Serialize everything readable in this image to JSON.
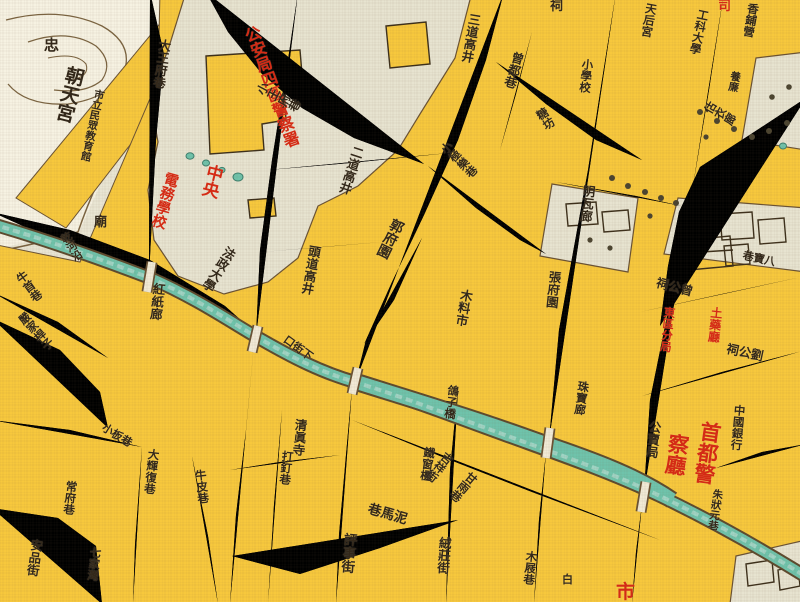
{
  "map": {
    "palette": {
      "base_paper": "#e9e5d3",
      "block_yellow": "#f7c83d",
      "street_fill": "#f1ead6",
      "street_casing": "#6a5233",
      "canal_teal": "#6fc3ab",
      "hill_cream": "#f6f2e2",
      "compound_gray": "#e7e3d0",
      "label_black": "#33281a",
      "label_red": "#d42b15"
    },
    "labels": [
      {
        "id": "zhong",
        "text": "忠",
        "x": 44,
        "y": 38,
        "size": 15,
        "color": "black",
        "rot": 0,
        "dir": "h"
      },
      {
        "id": "chaotiangong",
        "text": "朝天宮",
        "x": 66,
        "y": 64,
        "size": 19,
        "color": "black",
        "rot": 14,
        "dir": "v"
      },
      {
        "id": "minzhong-jiaoyuguan",
        "text": "市立民眾教育館",
        "x": 94,
        "y": 88,
        "size": 10.5,
        "color": "black",
        "rot": 12,
        "dir": "v"
      },
      {
        "id": "dawangfuxiang",
        "text": "大王府巷",
        "x": 158,
        "y": 38,
        "size": 12.5,
        "color": "black",
        "rot": 8,
        "dir": "v"
      },
      {
        "id": "gonganju-jingchashu",
        "text": "公安局四區警察署",
        "x": 240,
        "y": 30,
        "size": 16,
        "color": "red",
        "rot": -20,
        "dir": "v",
        "colh": 64
      },
      {
        "id": "xiaowangfuxiang",
        "text": "小王府巷",
        "x": 254,
        "y": 92,
        "size": 12,
        "color": "black",
        "rot": -62,
        "dir": "v"
      },
      {
        "id": "zhongyang",
        "text": "中央",
        "x": 206,
        "y": 162,
        "size": 17,
        "color": "red",
        "rot": 14,
        "dir": "v"
      },
      {
        "id": "dianwu-xuexiao",
        "text": "電務學校",
        "x": 164,
        "y": 170,
        "size": 14.5,
        "color": "red",
        "rot": 16,
        "dir": "v"
      },
      {
        "id": "fazheng-daxue",
        "text": "法政大學",
        "x": 226,
        "y": 244,
        "size": 12.5,
        "color": "black",
        "rot": 32,
        "dir": "v"
      },
      {
        "id": "hongzhilang",
        "text": "紅紙廊",
        "x": 152,
        "y": 282,
        "size": 12.5,
        "color": "black",
        "rot": 6,
        "dir": "v"
      },
      {
        "id": "qianheyan",
        "text": "乾河沿",
        "x": 58,
        "y": 236,
        "size": 10.5,
        "color": "black",
        "rot": -30,
        "dir": "v"
      },
      {
        "id": "niushouxiang",
        "text": "牛首巷",
        "x": 14,
        "y": 276,
        "size": 11.5,
        "color": "black",
        "rot": -36,
        "dir": "v"
      },
      {
        "id": "yanjiaganzi",
        "text": "嚴家桿子",
        "x": 16,
        "y": 318,
        "size": 11.5,
        "color": "black",
        "rot": -42,
        "dir": "v"
      },
      {
        "id": "miao",
        "text": "廟",
        "x": 94,
        "y": 216,
        "size": 13,
        "color": "black",
        "rot": 0,
        "dir": "h"
      },
      {
        "id": "sandaogaojing",
        "text": "三道高井",
        "x": 468,
        "y": 12,
        "size": 12.5,
        "color": "black",
        "rot": 10,
        "dir": "v"
      },
      {
        "id": "erdaogaojing",
        "text": "二道高井",
        "x": 352,
        "y": 144,
        "size": 12.5,
        "color": "black",
        "rot": 18,
        "dir": "v"
      },
      {
        "id": "toudaogaojing",
        "text": "頭道高井",
        "x": 308,
        "y": 244,
        "size": 12.5,
        "color": "black",
        "rot": 10,
        "dir": "v"
      },
      {
        "id": "zengduxiang",
        "text": "曾都巷",
        "x": 512,
        "y": 50,
        "size": 12.5,
        "color": "black",
        "rot": 16,
        "dir": "v"
      },
      {
        "id": "xiaoxuexiao",
        "text": "小學校",
        "x": 582,
        "y": 58,
        "size": 11.5,
        "color": "black",
        "rot": 6,
        "dir": "v"
      },
      {
        "id": "tangfang",
        "text": "糖坊",
        "x": 534,
        "y": 112,
        "size": 11.5,
        "color": "black",
        "rot": -32,
        "dir": "v"
      },
      {
        "id": "xiaojilexiang",
        "text": "小極樂巷",
        "x": 438,
        "y": 148,
        "size": 11.5,
        "color": "black",
        "rot": -46,
        "dir": "v"
      },
      {
        "id": "guofuyuan",
        "text": "郭府園",
        "x": 392,
        "y": 216,
        "size": 14,
        "color": "black",
        "rot": 26,
        "dir": "v"
      },
      {
        "id": "muliaoshi",
        "text": "木料市",
        "x": 460,
        "y": 288,
        "size": 12.5,
        "color": "black",
        "rot": 10,
        "dir": "v"
      },
      {
        "id": "zhangfuyuan",
        "text": "張府園",
        "x": 548,
        "y": 270,
        "size": 12.5,
        "color": "black",
        "rot": 6,
        "dir": "v"
      },
      {
        "id": "mingwalang",
        "text": "明瓦廊",
        "x": 582,
        "y": 184,
        "size": 12.5,
        "color": "black",
        "rot": 6,
        "dir": "v"
      },
      {
        "id": "tianhougong",
        "text": "天后宮",
        "x": 646,
        "y": 2,
        "size": 11.5,
        "color": "black",
        "rot": 10,
        "dir": "v"
      },
      {
        "id": "gongkedaxue",
        "text": "工科大學",
        "x": 698,
        "y": 8,
        "size": 11.5,
        "color": "black",
        "rot": 12,
        "dir": "v"
      },
      {
        "id": "xiangpuying",
        "text": "香鋪營",
        "x": 748,
        "y": 2,
        "size": 11.5,
        "color": "black",
        "rot": 10,
        "dir": "v"
      },
      {
        "id": "yanglian",
        "text": "養廉",
        "x": 730,
        "y": 70,
        "size": 10.5,
        "color": "black",
        "rot": 10,
        "dir": "v"
      },
      {
        "id": "guyilang",
        "text": "估衣廊",
        "x": 702,
        "y": 110,
        "size": 11.5,
        "color": "black",
        "rot": -60,
        "dir": "v"
      },
      {
        "id": "babaoxiang",
        "text": "巷寶八",
        "x": 744,
        "y": 250,
        "size": 11,
        "color": "black",
        "rot": 12,
        "dir": "h"
      },
      {
        "id": "zenggongci",
        "text": "祠公曾",
        "x": 658,
        "y": 276,
        "size": 12.5,
        "color": "black",
        "rot": 14,
        "dir": "h"
      },
      {
        "id": "tuyaoting",
        "text": "土藥廳",
        "x": 710,
        "y": 306,
        "size": 12,
        "color": "red",
        "rot": 6,
        "dir": "v"
      },
      {
        "id": "dongqufenju",
        "text": "東區分局",
        "x": 664,
        "y": 306,
        "size": 11.5,
        "color": "red",
        "rot": 6,
        "dir": "v"
      },
      {
        "id": "liugongci",
        "text": "祠公劉",
        "x": 728,
        "y": 342,
        "size": 12.5,
        "color": "black",
        "rot": 12,
        "dir": "h"
      },
      {
        "id": "zhubaolang",
        "text": "珠寶廊",
        "x": 578,
        "y": 380,
        "size": 11.5,
        "color": "black",
        "rot": 8,
        "dir": "v"
      },
      {
        "id": "gongmaiju",
        "text": "公賣局",
        "x": 648,
        "y": 420,
        "size": 12.5,
        "color": "black",
        "rot": 6,
        "dir": "v"
      },
      {
        "id": "shoudujing",
        "text": "首都警",
        "x": 700,
        "y": 420,
        "size": 21,
        "color": "red",
        "rot": 8,
        "dir": "v"
      },
      {
        "id": "chating",
        "text": "察廳",
        "x": 668,
        "y": 432,
        "size": 21,
        "color": "red",
        "rot": 8,
        "dir": "v"
      },
      {
        "id": "zhongguo-yinhang",
        "text": "中國銀行",
        "x": 734,
        "y": 404,
        "size": 11.5,
        "color": "black",
        "rot": 5,
        "dir": "v"
      },
      {
        "id": "zhuzhuangyuanxiang",
        "text": "朱狀元巷",
        "x": 712,
        "y": 488,
        "size": 10.5,
        "color": "black",
        "rot": 8,
        "dir": "v"
      },
      {
        "id": "geziqiao",
        "text": "鴿子橋",
        "x": 448,
        "y": 384,
        "size": 11.5,
        "color": "black",
        "rot": 8,
        "dir": "v"
      },
      {
        "id": "tiechuangling",
        "text": "鐵窗欞",
        "x": 424,
        "y": 446,
        "size": 11.5,
        "color": "black",
        "rot": 8,
        "dir": "v"
      },
      {
        "id": "xiajiekou",
        "text": "口街下",
        "x": 288,
        "y": 334,
        "size": 11,
        "color": "black",
        "rot": 36,
        "dir": "h"
      },
      {
        "id": "qingzhensi",
        "text": "清眞寺",
        "x": 294,
        "y": 418,
        "size": 12.5,
        "color": "black",
        "rot": 5,
        "dir": "v"
      },
      {
        "id": "dadingxiang",
        "text": "打釘巷",
        "x": 282,
        "y": 450,
        "size": 11.5,
        "color": "black",
        "rot": 6,
        "dir": "v"
      },
      {
        "id": "pingshijie",
        "text": "評事街",
        "x": 342,
        "y": 532,
        "size": 13.5,
        "color": "black",
        "rot": 5,
        "dir": "v"
      },
      {
        "id": "nimaxiang",
        "text": "巷馬泥",
        "x": 370,
        "y": 502,
        "size": 13.5,
        "color": "black",
        "rot": 16,
        "dir": "h"
      },
      {
        "id": "jixiangjie",
        "text": "吉祥街",
        "x": 446,
        "y": 450,
        "size": 11.5,
        "color": "black",
        "rot": 40,
        "dir": "v"
      },
      {
        "id": "ganyuxiang",
        "text": "甘雨巷",
        "x": 470,
        "y": 470,
        "size": 11.5,
        "color": "black",
        "rot": 40,
        "dir": "v"
      },
      {
        "id": "rongzhuangjie",
        "text": "絨莊街",
        "x": 438,
        "y": 536,
        "size": 12.5,
        "color": "black",
        "rot": 4,
        "dir": "v"
      },
      {
        "id": "dahuifuxiang",
        "text": "大輝復巷",
        "x": 148,
        "y": 448,
        "size": 11.5,
        "color": "black",
        "rot": 6,
        "dir": "v"
      },
      {
        "id": "xiaobanxiang",
        "text": "小板巷",
        "x": 106,
        "y": 422,
        "size": 11,
        "color": "black",
        "rot": 32,
        "dir": "h"
      },
      {
        "id": "niupixiang",
        "text": "牛皮巷",
        "x": 194,
        "y": 470,
        "size": 11.5,
        "color": "black",
        "rot": -6,
        "dir": "v"
      },
      {
        "id": "changfuxiang",
        "text": "常府巷",
        "x": 66,
        "y": 480,
        "size": 11.5,
        "color": "black",
        "rot": 6,
        "dir": "v"
      },
      {
        "id": "anpinjie",
        "text": "安品街",
        "x": 30,
        "y": 538,
        "size": 12.5,
        "color": "black",
        "rot": 8,
        "dir": "v"
      },
      {
        "id": "qijiawan",
        "text": "七家灣",
        "x": 90,
        "y": 546,
        "size": 11.5,
        "color": "black",
        "rot": 6,
        "dir": "v"
      },
      {
        "id": "mujixiang",
        "text": "木屐巷",
        "x": 526,
        "y": 550,
        "size": 11.5,
        "color": "black",
        "rot": 6,
        "dir": "v"
      },
      {
        "id": "bai",
        "text": "白",
        "x": 562,
        "y": 574,
        "size": 11,
        "color": "black",
        "rot": 0,
        "dir": "h"
      },
      {
        "id": "ci-top-edge",
        "text": "祠",
        "x": 550,
        "y": 0,
        "size": 13,
        "color": "black",
        "rot": 0,
        "dir": "h"
      },
      {
        "id": "si-top-edge",
        "text": "司",
        "x": 718,
        "y": 0,
        "size": 13,
        "color": "red",
        "rot": 0,
        "dir": "h"
      },
      {
        "id": "shi-bottom-edge",
        "text": "市",
        "x": 616,
        "y": 582,
        "size": 19,
        "color": "red",
        "rot": 0,
        "dir": "h"
      }
    ]
  }
}
